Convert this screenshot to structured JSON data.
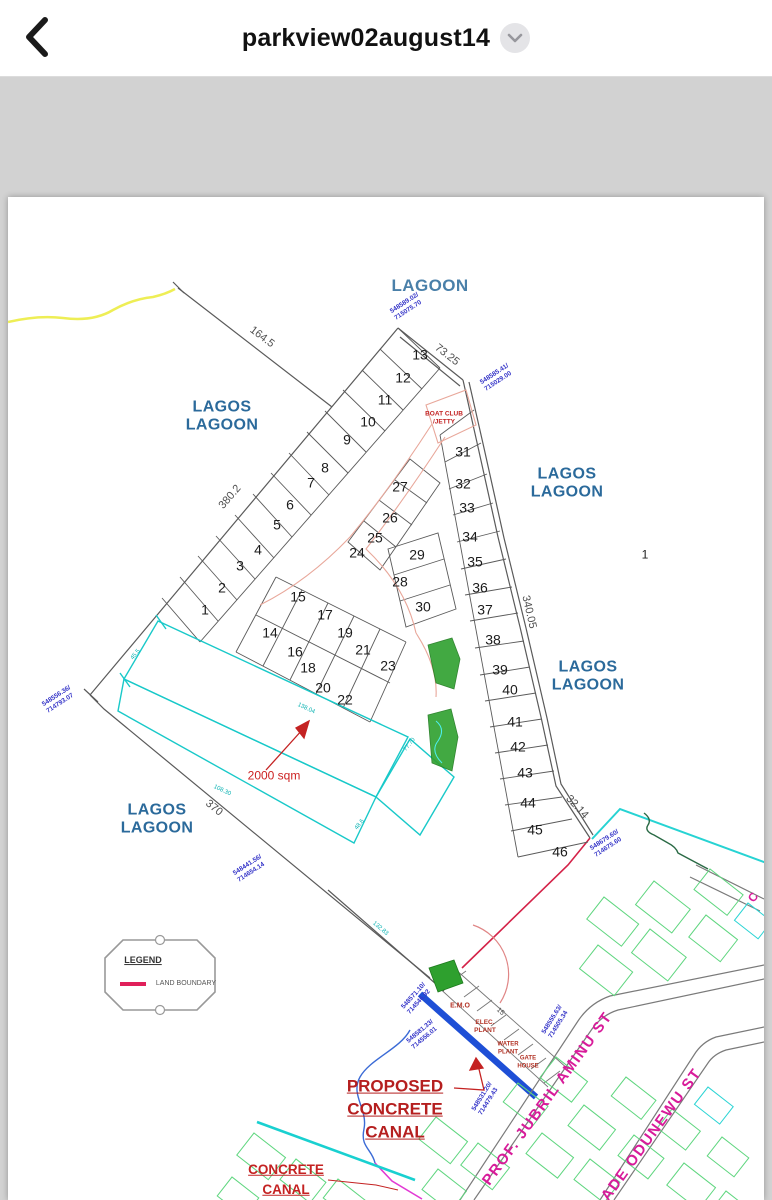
{
  "header": {
    "title": "parkview02august14",
    "back_icon": "chevron-left",
    "menu_icon": "chevron-down"
  },
  "map": {
    "labels": {
      "lagos": "LAGOS",
      "lagoon": "LAGOON"
    },
    "plot_numbers": [
      "1",
      "2",
      "3",
      "4",
      "5",
      "6",
      "7",
      "8",
      "9",
      "10",
      "11",
      "12",
      "13",
      "14",
      "15",
      "16",
      "17",
      "18",
      "19",
      "20",
      "21",
      "22",
      "23",
      "24",
      "25",
      "26",
      "27",
      "28",
      "29",
      "30",
      "31",
      "32",
      "33",
      "34",
      "35",
      "36",
      "37",
      "38",
      "39",
      "40",
      "41",
      "42",
      "43",
      "44",
      "45",
      "46"
    ],
    "outside_plot": "1",
    "dims": {
      "d164": "164.5",
      "d73": "73.25",
      "d380": "380.2",
      "d340": "340.05",
      "d370": "370",
      "d32": "32.14",
      "d15": "15"
    },
    "small_dims": {
      "s1": "138.04",
      "s2": "108.30",
      "s3": "45.5",
      "s4": "48.6",
      "s5": "77.70",
      "s6": "132.83"
    },
    "coords": {
      "c1": {
        "a": "548589.02/",
        "b": "715075.70"
      },
      "c2": {
        "a": "548585.41/",
        "b": "715029.00"
      },
      "c3": {
        "a": "548556.36/",
        "b": "714793.07"
      },
      "c4": {
        "a": "548441.56/",
        "b": "714654.14"
      },
      "c5": {
        "a": "548679.60/",
        "b": "714675.60"
      },
      "c6": {
        "a": "548571.10/",
        "b": "714546.92"
      },
      "c7": {
        "a": "548581.33/",
        "b": "714556.01"
      },
      "c8": {
        "a": "548555.63/",
        "b": "714505.34"
      },
      "c9": {
        "a": "548531.20/",
        "b": "714479.43"
      }
    },
    "annotations": {
      "boat_club_1": "BOAT CLUB",
      "boat_club_2": "/JETTY",
      "area": "2000 sqm",
      "emo": "E.M.O",
      "elec_1": "ELEC.",
      "elec_2": "PLANT",
      "water_1": "WATER",
      "water_2": "PLANT",
      "gate_1": "GATE",
      "gate_2": "HOUSE",
      "proposed_1": "PROPOSED",
      "proposed_2": "CONCRETE",
      "proposed_3": "CANAL",
      "canal_1": "CONCRETE",
      "canal_2": "CANAL"
    },
    "streets": {
      "jubril": "PROF. JUBRIL AMINU ST",
      "ade": "ADE ODUNEWU ST",
      "partial": "C"
    },
    "legend": {
      "title": "LEGEND",
      "land_boundary": "LAND BOUNDARY"
    },
    "colors": {
      "lagoon_text": "#2b6a9b",
      "coordinate_text": "#3535c8",
      "dimension_text": "#4f4f4f",
      "red_annotation": "#c42222",
      "street_text": "#d81b9a",
      "land_boundary_red": "#d42248",
      "proposed_canal_blue": "#1e4fd6",
      "survey_cyan": "#19c9c9",
      "parcel_green": "#5fd67f",
      "patch_green": "#2ea02e"
    }
  }
}
